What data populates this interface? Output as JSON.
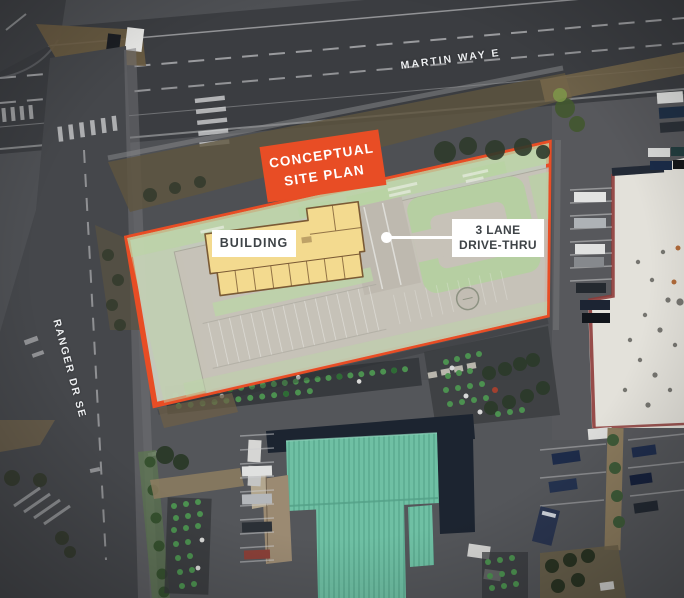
{
  "streets": {
    "martin_way": "MARTIN WAY E",
    "ranger_dr": "RANGER DR SE"
  },
  "badge": {
    "line1": "CONCEPTUAL",
    "line2": "SITE PLAN"
  },
  "plan_labels": {
    "building": "BUILDING",
    "drive_thru_line1": "3 LANE",
    "drive_thru_line2": "DRIVE-THRU"
  },
  "colors": {
    "accent_orange": "#E84D25",
    "plan_fill": "#CBCFC1",
    "building_yellow": "#F3DA8F",
    "roof_teal": "#6FC0A4",
    "label_text": "#3E4347"
  }
}
